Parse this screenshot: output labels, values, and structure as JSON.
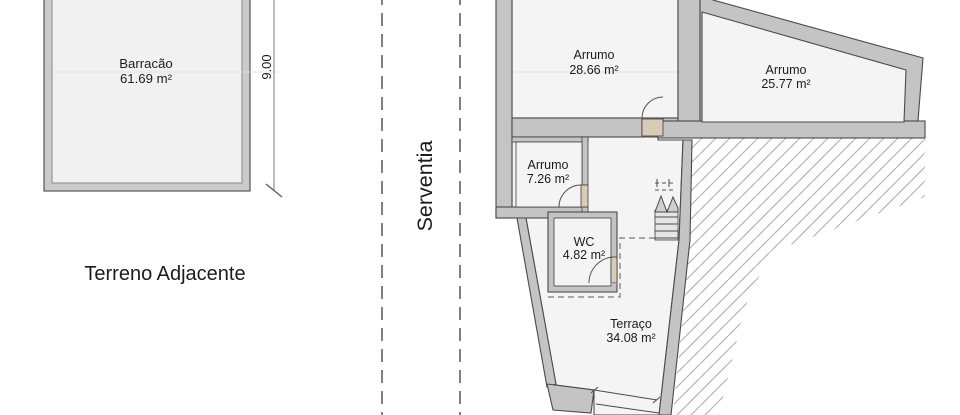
{
  "plan": {
    "site": {
      "barracao": {
        "name": "Barracão",
        "area": "61.69 m²"
      },
      "adjacent_label": "Terreno Adjacente",
      "dimension_right": "9.00"
    },
    "serventia_label": "Serventia",
    "rooms": [
      {
        "name": "Arrumo",
        "area": "28.66 m²"
      },
      {
        "name": "Arrumo",
        "area": "25.77 m²"
      },
      {
        "name": "Arrumo",
        "area": "7.26 m²"
      },
      {
        "name": "WC",
        "area": "4.82 m²"
      },
      {
        "name": "Terraço",
        "area": "34.08 m²"
      }
    ],
    "colors": {
      "wall": "#c4c4c4",
      "room": "#f4f4f4",
      "door": "#d8cdb4",
      "hatch": "#adadad",
      "outline": "#4a4a4a",
      "text": "#1c1c1c"
    }
  }
}
